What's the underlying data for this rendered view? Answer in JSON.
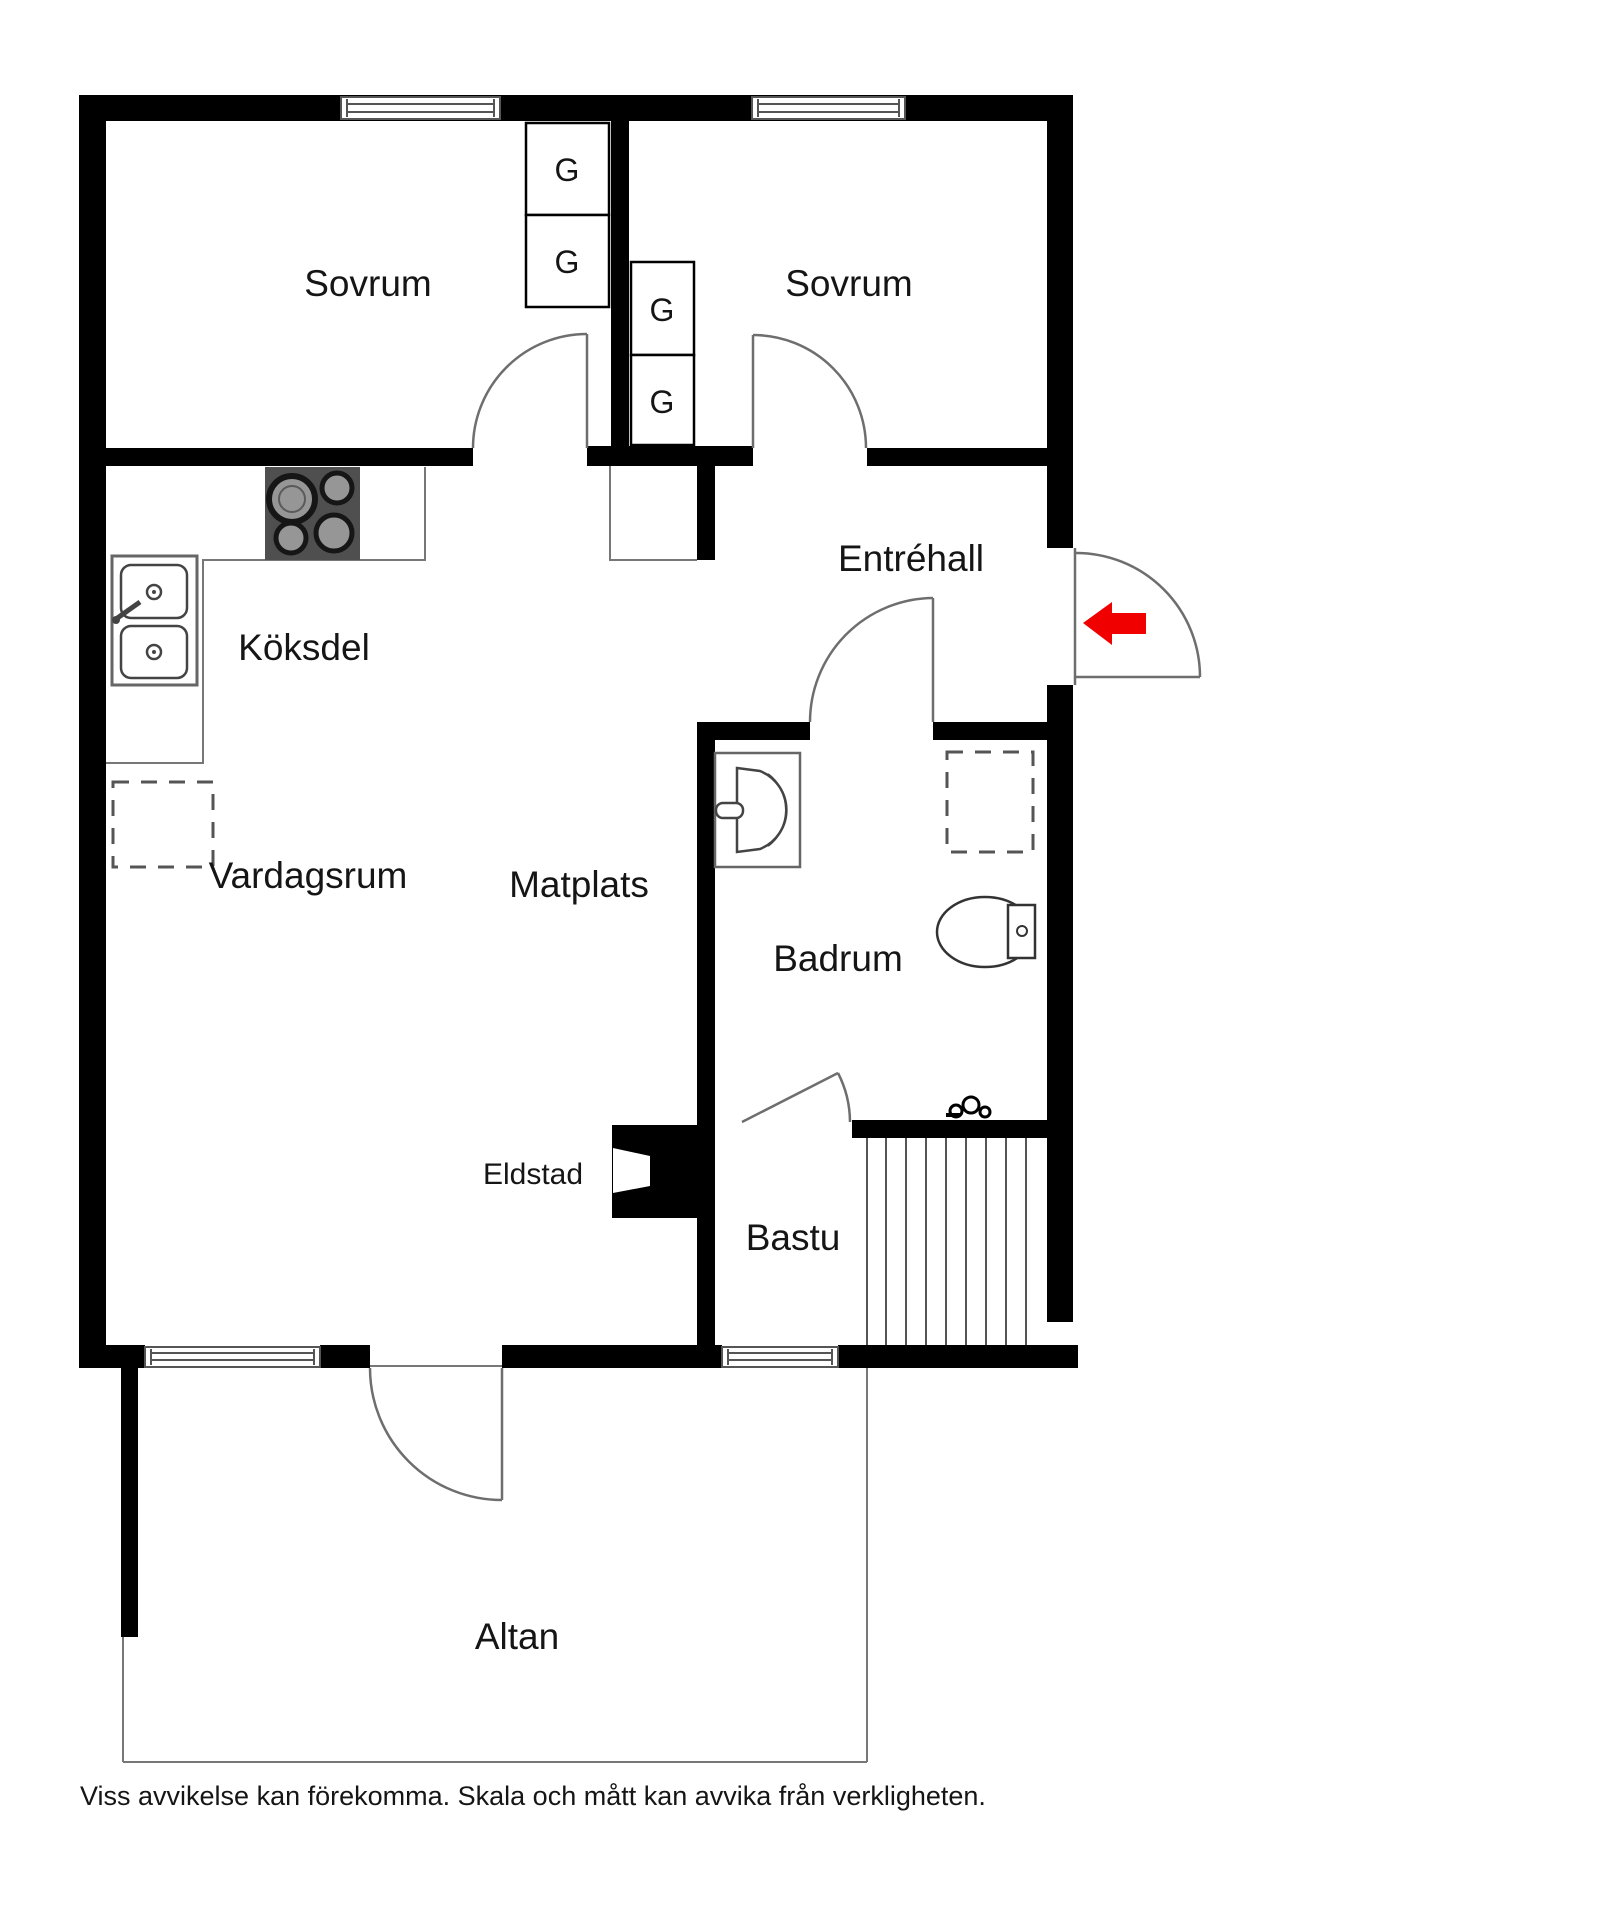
{
  "rooms": {
    "bedroom1": "Sovrum",
    "bedroom2": "Sovrum",
    "kitchen": "Köksdel",
    "dining": "Matplats",
    "living": "Vardagsrum",
    "entry": "Entréhall",
    "bathroom": "Badrum",
    "sauna": "Bastu",
    "fireplace": "Eldstad",
    "terrace": "Altan"
  },
  "closets": {
    "label": "G"
  },
  "colors": {
    "wall": "#000000",
    "thin_line": "#777777",
    "arrow": "#f10000"
  },
  "footer": {
    "disclaimer": "Viss avvikelse kan förekomma. Skala och mått kan avvika från verkligheten."
  }
}
